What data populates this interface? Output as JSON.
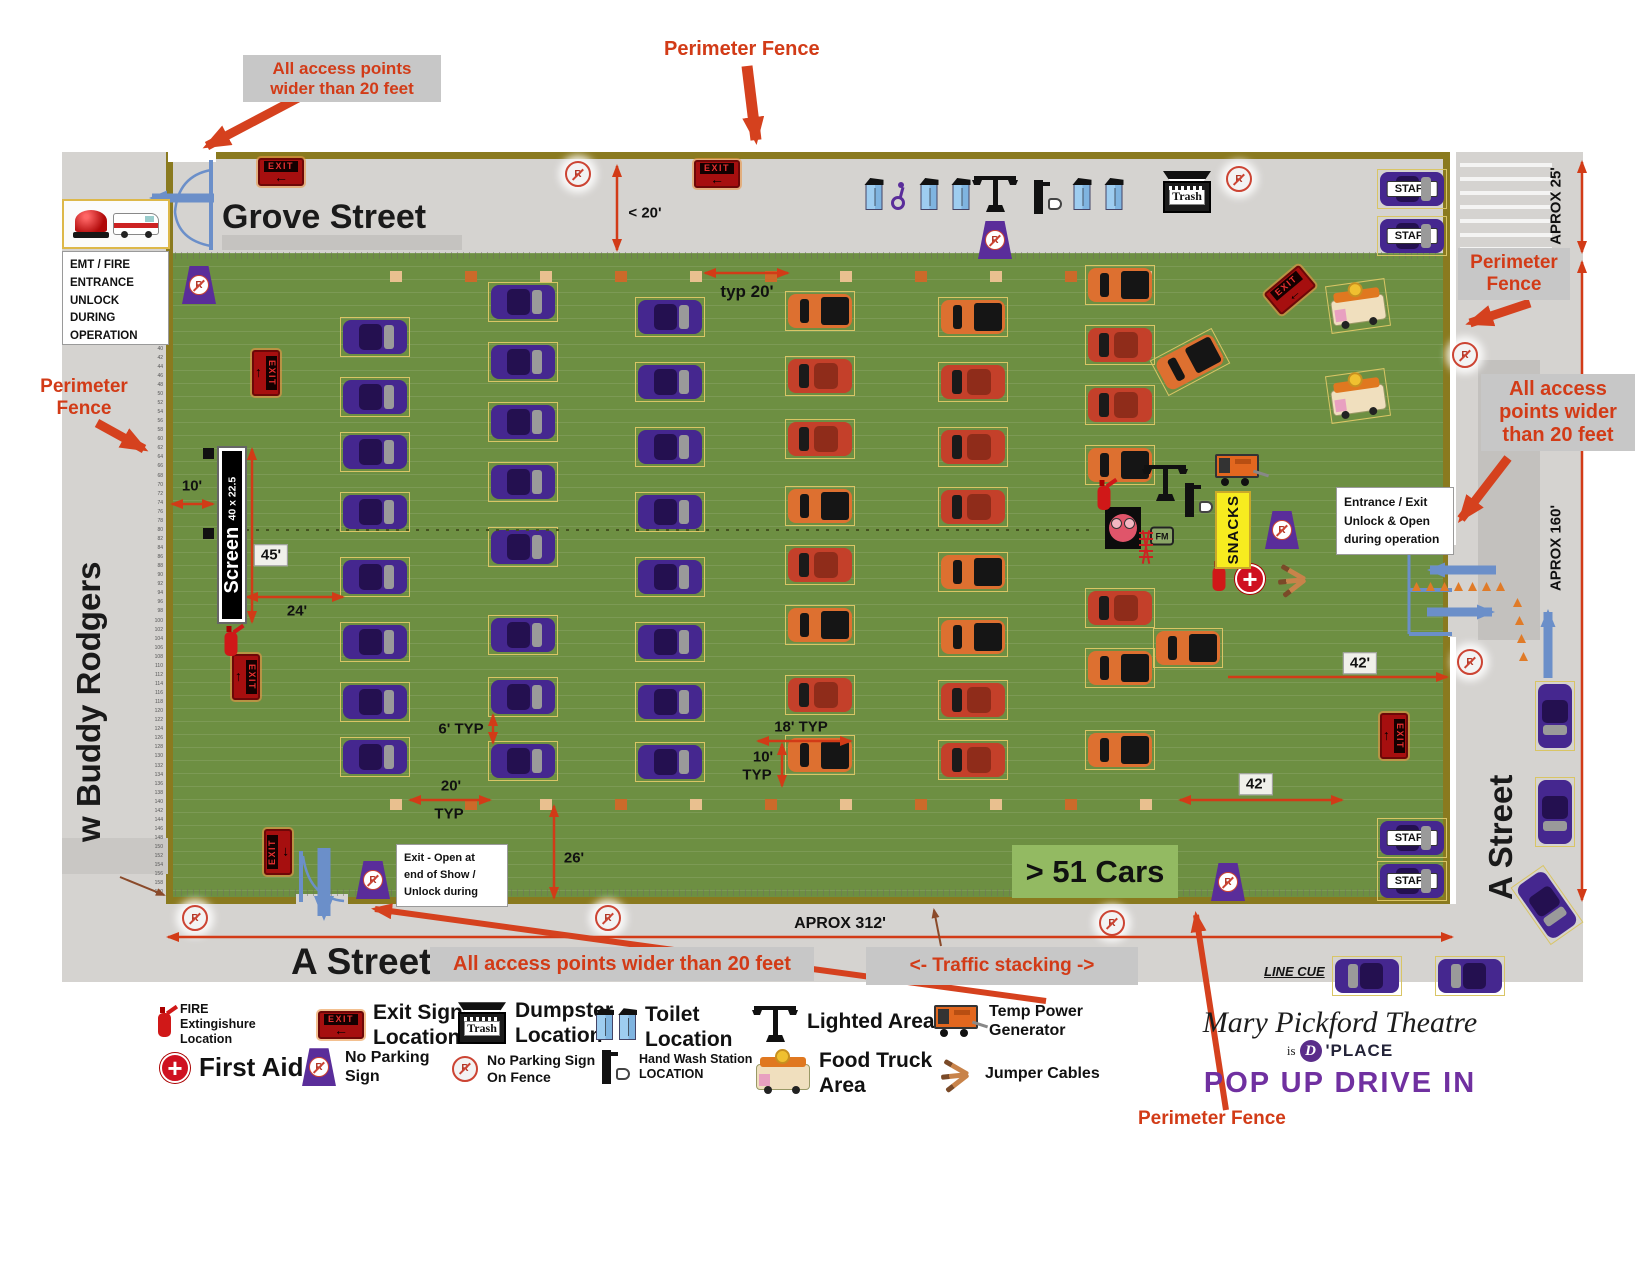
{
  "title": "Mary Pickford Theatre Pop Up Drive In site plan",
  "colors": {
    "field_green": "#6d8f42",
    "fence_olive": "#8a7a1f",
    "street_gray": "#d5d3d0",
    "annotation_red": "#d23b17",
    "car_purple": "#45278f",
    "car_red": "#c4402a",
    "car_orange": "#dd7030",
    "accent_blue": "#6b8fc9",
    "pop_purple": "#7030a0",
    "snacks_yellow": "#f7ec1f",
    "badge_green": "#93ba62"
  },
  "streets": {
    "top": "Grove Street",
    "left": "w Buddy Rodgers",
    "bottom": "A Street",
    "right": "A Street"
  },
  "annotations": {
    "access_tl": "All access points\nwider than 20 feet",
    "access_right": "All access\npoints wider\nthan 20 feet",
    "access_bottom": "All access points wider than 20 feet",
    "perimeter_top": "Perimeter Fence",
    "perimeter_left": "Perimeter\nFence",
    "perimeter_right": "Perimeter\nFence",
    "perimeter_bottom": "Perimeter Fence",
    "traffic_stacking": "<- Traffic stacking ->",
    "line_cue": "LINE CUE",
    "cars_count": "> 51 Cars"
  },
  "boxes": {
    "emt": "EMT / FIRE\nENTRANCE\nUNLOCK\nDURING\nOPERATION",
    "entrance_exit": "Entrance / Exit\nUnlock & Open\nduring operation",
    "exit_open": "Exit - Open at\nend of Show /\nUnlock during"
  },
  "labels": {
    "staff": "STAFF",
    "snacks": "SNACKS",
    "screen_name": "Screen",
    "screen_size": "40 x 22.5",
    "trash": "Trash",
    "fm": "FM",
    "exit": "EXIT",
    "no_parking_r": "R",
    "first_aid_plus": "+"
  },
  "dimensions": [
    {
      "t": "< 20'",
      "x": 645,
      "y": 213
    },
    {
      "t": "typ 20'",
      "x": 747,
      "y": 292,
      "fs": 17
    },
    {
      "t": "10'",
      "x": 192,
      "y": 486
    },
    {
      "t": "45'",
      "x": 271,
      "y": 555,
      "bx": 1
    },
    {
      "t": "24'",
      "x": 297,
      "y": 611
    },
    {
      "t": "6' TYP",
      "x": 461,
      "y": 729
    },
    {
      "t": "18' TYP",
      "x": 801,
      "y": 727
    },
    {
      "t": "10'",
      "x": 763,
      "y": 757
    },
    {
      "t": "TYP",
      "x": 757,
      "y": 775
    },
    {
      "t": "20'",
      "x": 451,
      "y": 786
    },
    {
      "t": "TYP",
      "x": 449,
      "y": 814
    },
    {
      "t": "26'",
      "x": 574,
      "y": 858
    },
    {
      "t": "42'",
      "x": 1360,
      "y": 663,
      "bx": 1
    },
    {
      "t": "42'",
      "x": 1256,
      "y": 784,
      "bx": 1
    },
    {
      "t": "APROX 312'",
      "x": 840,
      "y": 924,
      "fs": 16
    },
    {
      "t": "APROX 25'",
      "x": 1556,
      "y": 206,
      "vt": 1
    },
    {
      "t": "APROX 160'",
      "x": 1556,
      "y": 548,
      "vt": 1
    }
  ],
  "legend": {
    "items": [
      {
        "icon": "fire-ext",
        "label": "FIRE\nExtingishure\nLocation",
        "x": 158,
        "y": 1002,
        "size": "sm"
      },
      {
        "icon": "exit-sign",
        "label": "Exit Sign\nLocation",
        "x": 318,
        "y": 1000,
        "size": "lg"
      },
      {
        "icon": "trash",
        "label": "Dumpster\nLocation",
        "x": 458,
        "y": 998,
        "size": "lg"
      },
      {
        "icon": "toilet2",
        "label": "Toilet\nLocation",
        "x": 596,
        "y": 1002,
        "size": "lg"
      },
      {
        "icon": "light-pole",
        "label": "Lighted Area",
        "x": 752,
        "y": 1002,
        "size": "lg"
      },
      {
        "icon": "generator",
        "label": "Temp Power\nGenerator",
        "x": 934,
        "y": 1002,
        "size": "md"
      },
      {
        "icon": "first-aid",
        "label": "First Aid",
        "x": 160,
        "y": 1052,
        "size": "xl"
      },
      {
        "icon": "no-parking",
        "label": "No Parking\nSign",
        "x": 302,
        "y": 1048,
        "size": "md"
      },
      {
        "icon": "no-parking-fence",
        "label": "No Parking Sign\nOn Fence",
        "x": 452,
        "y": 1052,
        "size": "sm2"
      },
      {
        "icon": "hand-wash",
        "label": "Hand Wash Station\nLOCATION",
        "x": 600,
        "y": 1050,
        "size": "sm"
      },
      {
        "icon": "food-truck",
        "label": "Food Truck\nArea",
        "x": 756,
        "y": 1048,
        "size": "lg"
      },
      {
        "icon": "jumpers",
        "label": "Jumper Cables",
        "x": 932,
        "y": 1058,
        "size": "md"
      }
    ]
  },
  "logo": {
    "line1": "Mary Pickford Theatre",
    "is": "is",
    "d": "D",
    "place": "'PLACE",
    "subtitle": "POP UP DRIVE IN"
  },
  "ruler": {
    "start": 20,
    "end": 160,
    "step": 2
  },
  "map_items": {
    "cars": [
      [
        375,
        337,
        "p"
      ],
      [
        375,
        397,
        "p"
      ],
      [
        375,
        452,
        "p"
      ],
      [
        375,
        512,
        "p"
      ],
      [
        375,
        577,
        "p"
      ],
      [
        375,
        642,
        "p"
      ],
      [
        375,
        702,
        "p"
      ],
      [
        375,
        757,
        "p"
      ],
      [
        523,
        302,
        "p"
      ],
      [
        523,
        362,
        "p"
      ],
      [
        523,
        422,
        "p"
      ],
      [
        523,
        482,
        "p"
      ],
      [
        523,
        547,
        "p"
      ],
      [
        523,
        635,
        "p"
      ],
      [
        523,
        697,
        "p"
      ],
      [
        523,
        761,
        "p"
      ],
      [
        670,
        317,
        "p"
      ],
      [
        670,
        382,
        "p"
      ],
      [
        670,
        447,
        "p"
      ],
      [
        670,
        512,
        "p"
      ],
      [
        670,
        577,
        "p"
      ],
      [
        670,
        642,
        "p"
      ],
      [
        670,
        702,
        "p"
      ],
      [
        670,
        762,
        "p"
      ],
      [
        820,
        311,
        "o"
      ],
      [
        820,
        376,
        "r"
      ],
      [
        820,
        439,
        "r"
      ],
      [
        820,
        506,
        "o"
      ],
      [
        820,
        565,
        "r"
      ],
      [
        820,
        625,
        "o"
      ],
      [
        820,
        695,
        "r"
      ],
      [
        820,
        755,
        "o"
      ],
      [
        973,
        317,
        "o"
      ],
      [
        973,
        382,
        "r"
      ],
      [
        973,
        447,
        "r"
      ],
      [
        973,
        507,
        "r"
      ],
      [
        973,
        572,
        "o"
      ],
      [
        973,
        637,
        "o"
      ],
      [
        973,
        700,
        "r"
      ],
      [
        973,
        760,
        "r"
      ],
      [
        1120,
        285,
        "o"
      ],
      [
        1120,
        345,
        "r"
      ],
      [
        1120,
        405,
        "r"
      ],
      [
        1120,
        465,
        "o"
      ],
      [
        1120,
        608,
        "r"
      ],
      [
        1120,
        668,
        "o"
      ],
      [
        1120,
        750,
        "o"
      ],
      [
        1190,
        362,
        "o",
        -28
      ],
      [
        1188,
        648,
        "o"
      ],
      [
        1412,
        189,
        "s"
      ],
      [
        1412,
        236,
        "s"
      ],
      [
        1412,
        838,
        "s"
      ],
      [
        1412,
        881,
        "s"
      ],
      [
        1358,
        306,
        "f",
        -8
      ],
      [
        1358,
        396,
        "f",
        -8
      ],
      [
        1555,
        716,
        "p",
        90
      ],
      [
        1555,
        812,
        "p",
        90
      ],
      [
        1547,
        905,
        "p",
        55
      ],
      [
        1367,
        976,
        "p",
        180
      ],
      [
        1470,
        976,
        "p",
        180
      ]
    ],
    "exit_signs": [
      [
        281,
        172,
        0
      ],
      [
        717,
        174,
        0
      ],
      [
        266,
        373,
        90
      ],
      [
        246,
        677,
        90
      ],
      [
        278,
        852,
        -90
      ],
      [
        1290,
        290,
        -40
      ],
      [
        1394,
        736,
        90
      ]
    ],
    "no_parking_aframe": [
      [
        199,
        285
      ],
      [
        995,
        240
      ],
      [
        1282,
        530
      ],
      [
        373,
        880
      ],
      [
        1228,
        882
      ]
    ],
    "no_parking_fence": [
      [
        578,
        174
      ],
      [
        1239,
        179
      ],
      [
        1465,
        355
      ],
      [
        1470,
        662
      ],
      [
        195,
        918
      ],
      [
        608,
        918
      ],
      [
        1112,
        923
      ]
    ],
    "icons": [
      [
        "toilet",
        874,
        197
      ],
      [
        "wheelchair",
        900,
        196
      ],
      [
        "toilet",
        929,
        197
      ],
      [
        "toilet",
        961,
        197
      ],
      [
        "light-pole",
        995,
        192
      ],
      [
        "hand-wash",
        1047,
        197
      ],
      [
        "toilet",
        1082,
        197
      ],
      [
        "toilet",
        1114,
        197
      ],
      [
        "trash",
        1187,
        192
      ],
      [
        "light-pole",
        1165,
        481
      ],
      [
        "generator",
        1238,
        470
      ],
      [
        "projector",
        1123,
        528
      ],
      [
        "fm",
        1162,
        536
      ],
      [
        "tower",
        1146,
        547
      ],
      [
        "hand-wash",
        1198,
        500
      ],
      [
        "fire-ext",
        1104,
        498
      ],
      [
        "fire-ext",
        1219,
        579
      ],
      [
        "first-aid",
        1250,
        579
      ],
      [
        "jumpers",
        1291,
        579
      ],
      [
        "fire-ext",
        231,
        644
      ]
    ],
    "markers": {
      "ys": [
        271,
        799
      ],
      "x0": 390,
      "dx": 75,
      "n": 11
    }
  }
}
